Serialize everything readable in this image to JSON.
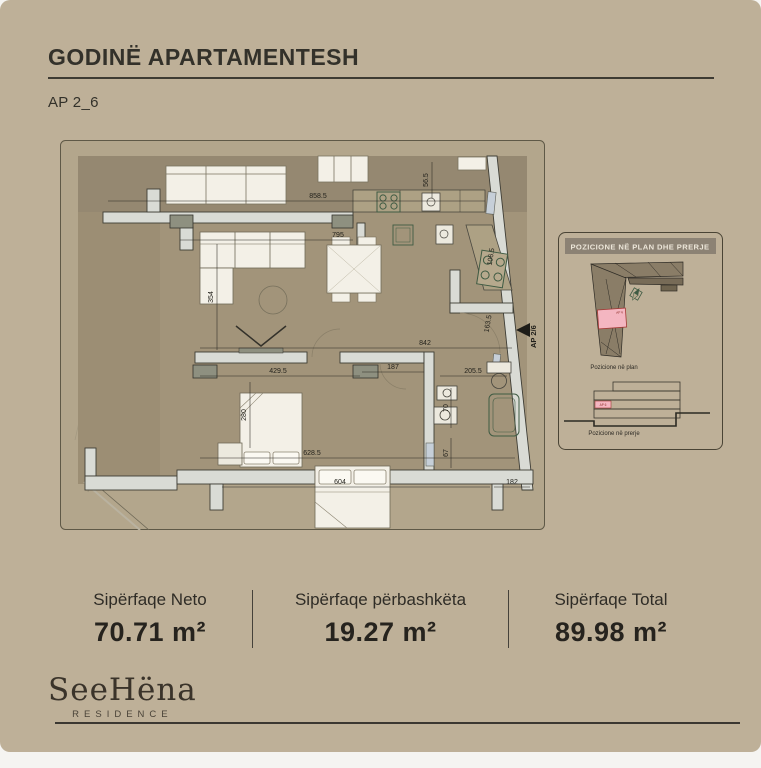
{
  "header": {
    "title": "GODINË APARTAMENTESH",
    "subtitle": "AP 2_6"
  },
  "plan": {
    "entrance_label": "AP 2/6",
    "dims": {
      "d1": "858.5",
      "d2": "56.5",
      "d3": "795",
      "d4": "354",
      "d5": "106.5",
      "d6": "163.5",
      "d7": "842",
      "d8": "429.5",
      "d9": "187",
      "d10": "280",
      "d11": "205.5",
      "d12": "70",
      "d13": "628.5",
      "d14": "67",
      "d15": "604",
      "d16": "182"
    }
  },
  "inset": {
    "title": "POZICIONE NË PLAN DHE PRERJE",
    "plan_caption": "Pozicione në plan",
    "section_caption": "Pozicione në prerje",
    "plan_unit_label": "AP 6",
    "section_unit_label": "AP 6",
    "highlight_color": "#f4b6c1"
  },
  "stats": [
    {
      "label": "Sipërfaqe Neto",
      "value": "70.71 m²"
    },
    {
      "label": "Sipërfaqe përbashkëta",
      "value": "19.27 m²"
    },
    {
      "label": "Sipërfaqe Total",
      "value": "89.98 m²"
    }
  ],
  "footer": {
    "brand": "SeeHëna",
    "brand_sub": "RESIDENCE"
  },
  "colors": {
    "page_bg": "#beb098",
    "accent_dark": "#33312a",
    "wall": "#d9dbd5",
    "fixture_green": "#3f5b43",
    "highlight_pink": "#f4b6c1"
  }
}
